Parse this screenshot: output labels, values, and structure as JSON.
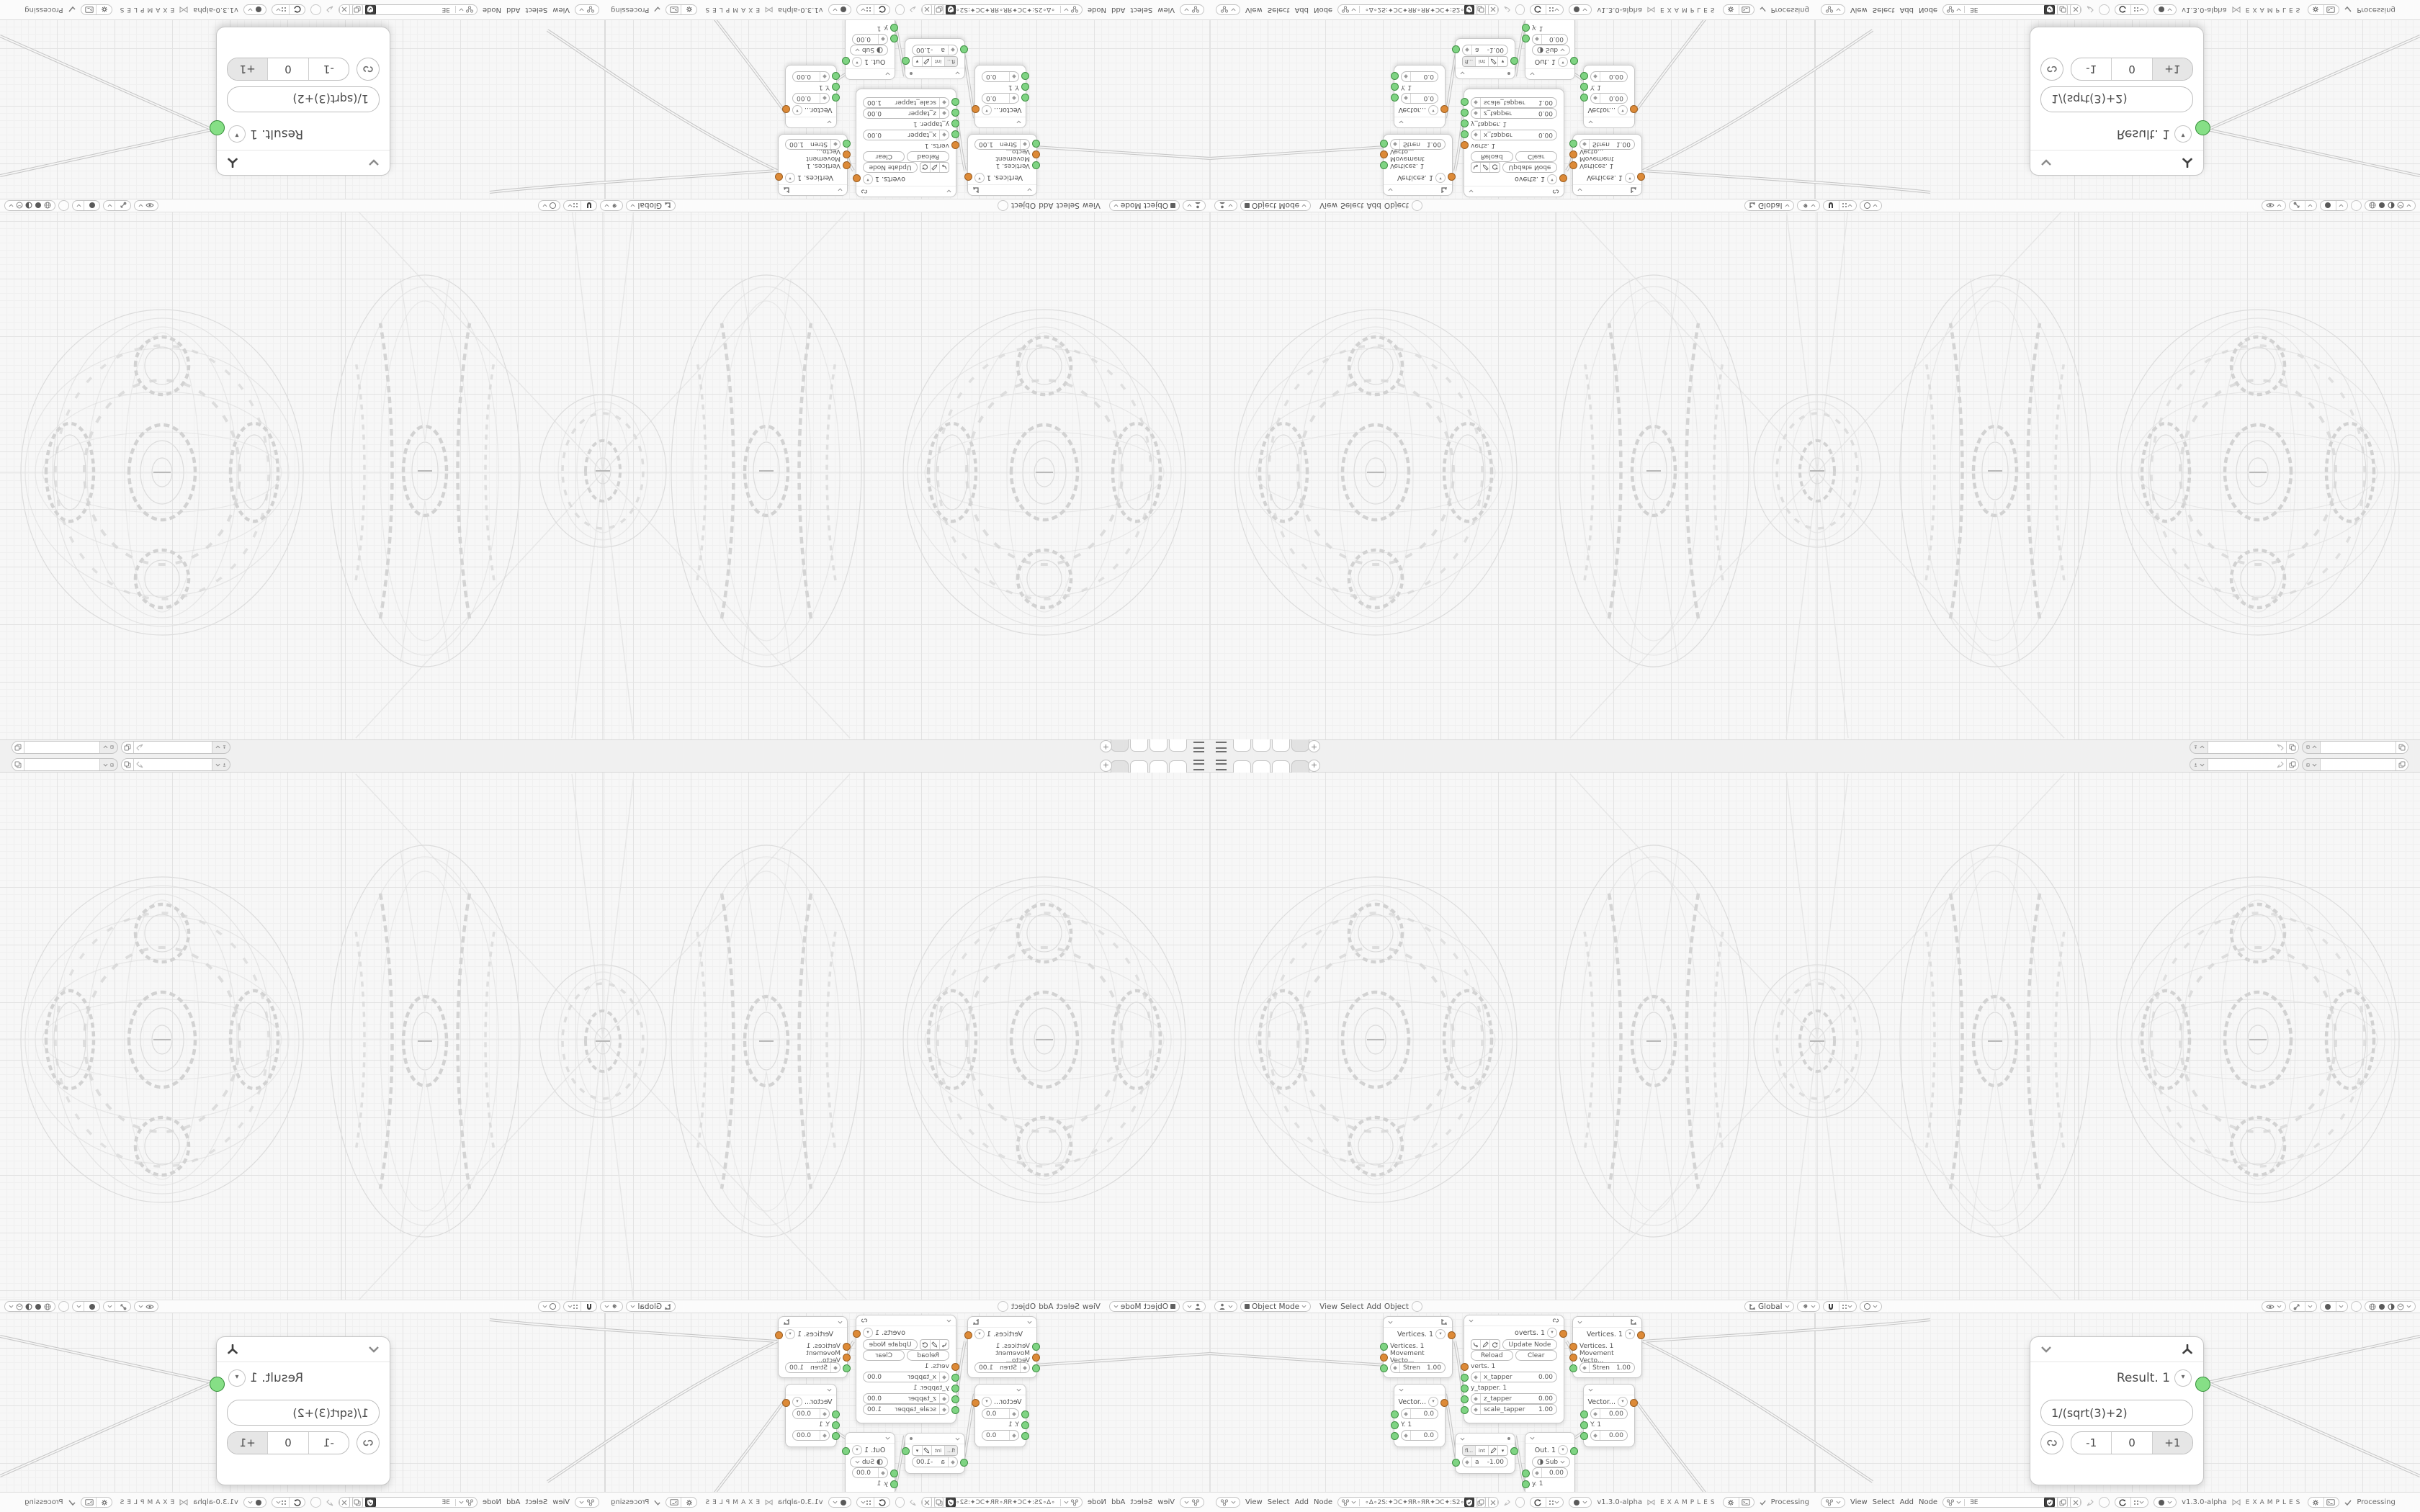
{
  "app": {
    "version": "v1.3.0-alpha",
    "brand": "EXAMPLES",
    "status_label": "Processing",
    "tree_name_left": "∘Δ∘2S:✦ϽC✦ЯR∘ЯR✦ϽC✦:S2∘Δ∘",
    "tree_name_right": "ƎE"
  },
  "viewport_header": {
    "mode": "Object Mode",
    "orientation": "Global",
    "menus": {
      "view": "View",
      "select": "Select",
      "add": "Add",
      "object": "Object"
    }
  },
  "node_editor_header": {
    "menus": {
      "view": "View",
      "select": "Select",
      "add": "Add",
      "node": "Node"
    }
  },
  "nodes": {
    "vertices": {
      "title": "Vertices. 1",
      "input1": "Vertices. 1",
      "input2": "Movement Vecto...",
      "stren_label": "Stren",
      "stren_value": "1.00"
    },
    "overts": {
      "title": "overts. 1",
      "update": "Update Node",
      "reload": "Reload",
      "clear": "Clear",
      "input": "verts. 1",
      "x_label": "x_tapper",
      "x_value": "0.00",
      "y_label": "y_tapper. 1",
      "z_label": "z_tapper",
      "z_value": "0.00",
      "scale_label": "scale_tapper",
      "scale_value": "1.00"
    },
    "vector_left": {
      "title": "Vector...",
      "v1": "0.0",
      "y": "Y. 1",
      "v2": "0.0"
    },
    "vector_right": {
      "title": "Vector...",
      "v1": "0.00",
      "y": "Y. 1",
      "v2": "0.00"
    },
    "math": {
      "b1": "fl...",
      "b2": "int",
      "a_label": "a",
      "a_value": "-1.00"
    },
    "out": {
      "title": "Out. 1",
      "op": "Sub",
      "value": "0.00",
      "input": "y. 1"
    },
    "result": {
      "title": "Result. 1",
      "expr": "1/(sqrt(3)+2)",
      "minus": "-1",
      "zero": "0",
      "plus": "+1"
    }
  }
}
